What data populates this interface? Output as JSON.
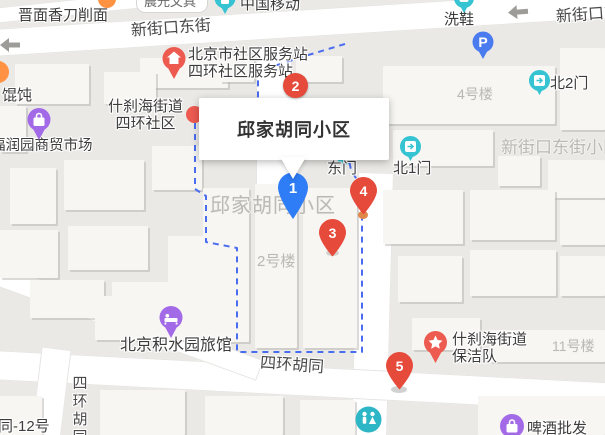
{
  "place_card": {
    "title": "邱家胡同小区"
  },
  "markers": {
    "m1": {
      "label": "1",
      "color": "#2e7cf6"
    },
    "m2": {
      "label": "2",
      "color": "#e64a3b"
    },
    "m3": {
      "label": "3",
      "color": "#e64a3b"
    },
    "m4": {
      "label": "4",
      "color": "#e64a3b"
    },
    "m5": {
      "label": "5",
      "color": "#e64a3b"
    }
  },
  "pois": {
    "chenguang": {
      "label": "晨光文具"
    },
    "china_mobile": {
      "label": "中国移动",
      "icon": "mobile-pin-teal"
    },
    "jinmian": {
      "label": "晋面香刀削面"
    },
    "xixie": {
      "label": "洗鞋",
      "icon": "pin-teal"
    },
    "fuwuzhan": {
      "line1": "北京市社区服务站",
      "line2": "四环社区服务站",
      "icon": "house-pin-red"
    },
    "shichahai_shequ": {
      "line1": "什刹海街道",
      "line2": "四环社区",
      "icon": "red-dot"
    },
    "huntun": {
      "label": "馄饨"
    },
    "market": {
      "label": "福润园商贸市场",
      "icon": "bag-pin-purple"
    },
    "parking": {
      "label": "P",
      "icon": "parking-pin-blue"
    },
    "dongmen": {
      "label": "东门",
      "icon": "gate-pin-teal"
    },
    "bei1men": {
      "label": "北1门",
      "icon": "gate-pin-teal"
    },
    "bei2men": {
      "label": "北2门",
      "icon": "gate-pin-teal"
    },
    "hotel": {
      "label": "北京积水园旅馆",
      "icon": "bed-pin-purple"
    },
    "baojiedui": {
      "line1": "什刹海街道",
      "line2": "保洁队",
      "icon": "star-pin-red"
    },
    "beer": {
      "label": "啤酒批发",
      "icon": "bag-pin-purple"
    },
    "toilet": {
      "icon": "wc-pin-teal"
    }
  },
  "roads": {
    "xinjiekou_dongjie": "新街口东街",
    "xinjiekou_dongjie_right": "新街口东街",
    "sihuan_hutong": "四环胡同",
    "sihuan_hutong_vertical": "四环胡同",
    "tong_12hao": "同-12号"
  },
  "gray_labels": {
    "qiujia_hutong_xiaoqu": "邱家胡同小区",
    "building_4": "4号楼",
    "building_2": "2号楼",
    "building_11": "11号楼",
    "xinjiekou_dongjie_xiaoqu": "新街口东街小区"
  },
  "colors": {
    "marker_red": "#e64a3b",
    "marker_blue": "#2e7cf6",
    "poi_teal": "#36c4d2",
    "poi_purple": "#a36ae8",
    "poi_red": "#ed5a50",
    "parking_blue": "#4a7cf0",
    "boundary_blue": "#4a6cf0",
    "ground": "#ebe9e6",
    "road": "#ffffff",
    "building": "#f7f6f3"
  }
}
